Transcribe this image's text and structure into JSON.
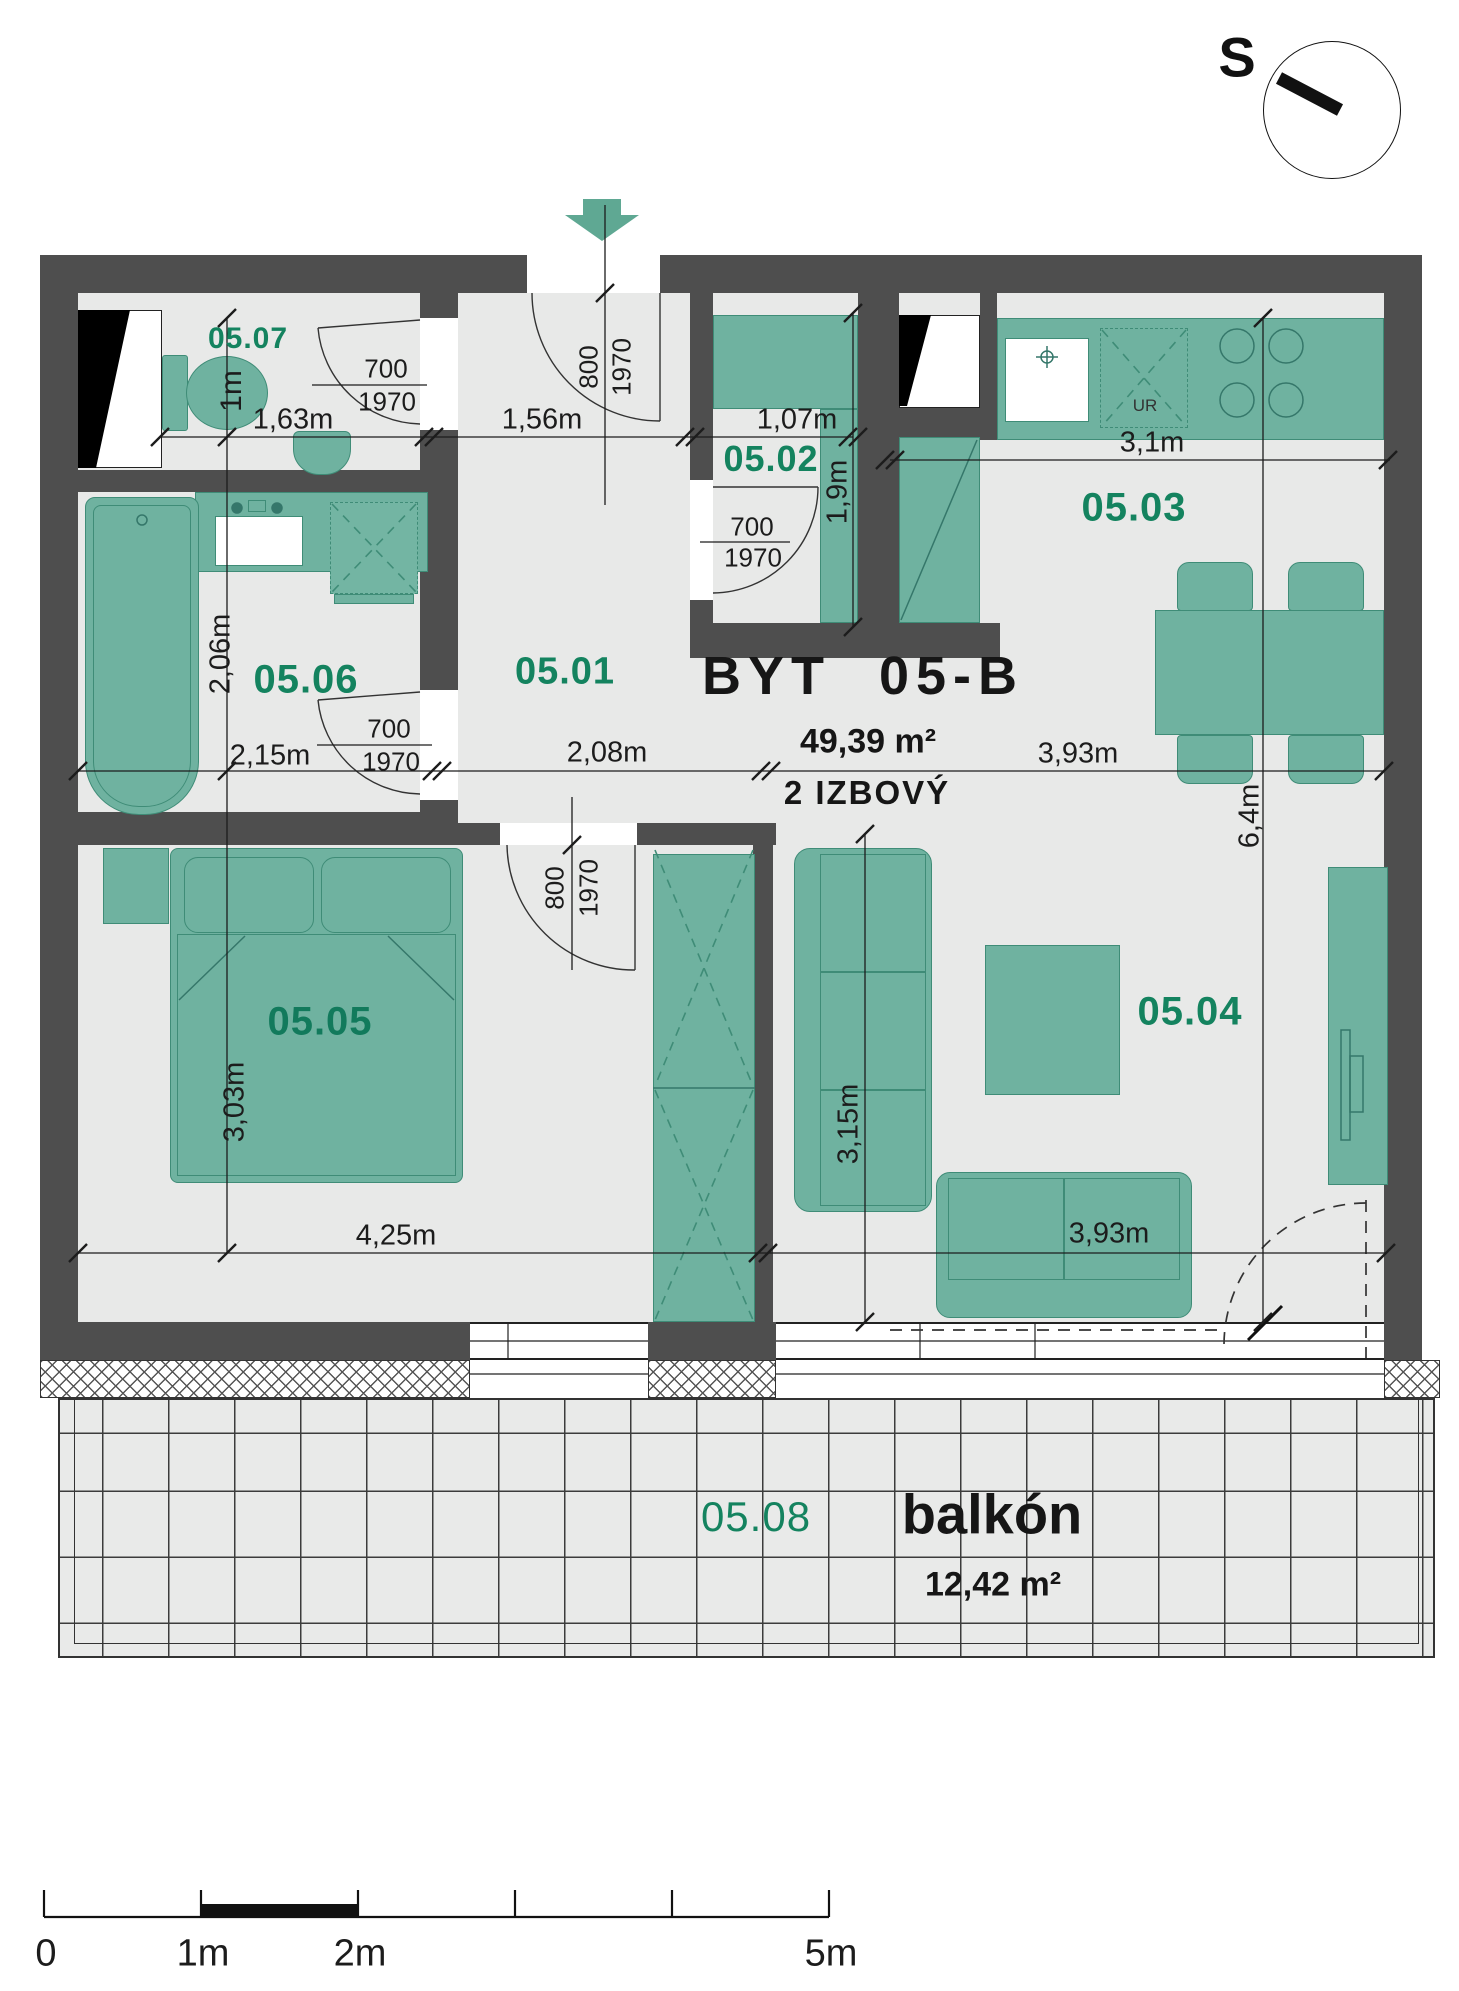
{
  "compass": {
    "letter": "S"
  },
  "title": {
    "name": "BYT 05-B",
    "area": "49,39 m²",
    "type": "2 IZBOVÝ"
  },
  "rooms": {
    "hall": "05.01",
    "closet": "05.02",
    "kitchen": "05.03",
    "living": "05.04",
    "bedroom": "05.05",
    "bathroom": "05.06",
    "wc": "05.07",
    "balcony": "05.08"
  },
  "balcony": {
    "name": "balkón",
    "area": "12,42 m²"
  },
  "appliances": {
    "fridge_label": "UR"
  },
  "dimensions": {
    "wc_width": "1,63m",
    "wc_depth": "1m",
    "entry_width": "1,56m",
    "closet_width": "1,07m",
    "closet_depth": "1,9m",
    "kitchen_width": "3,1m",
    "bathroom_width": "2,15m",
    "bathroom_depth": "2,06m",
    "hall_width": "2,08m",
    "living_width_top": "3,93m",
    "living_width_bottom": "3,93m",
    "living_depth": "6,4m",
    "living_inner_depth": "3,15m",
    "bedroom_width": "4,25m",
    "bedroom_depth": "3,03m"
  },
  "doors": {
    "w700": "700",
    "w800": "800",
    "h1970": "1970"
  },
  "scale_bar": {
    "labels": [
      "0",
      "1m",
      "2m",
      "5m"
    ]
  },
  "colors": {
    "wall": "#4e4e4e",
    "floor": "#e8e9e8",
    "furniture": "#6fb2a0",
    "furniture_border": "#3f8c77",
    "room_label": "#14835f",
    "arrow": "#5fa893"
  }
}
